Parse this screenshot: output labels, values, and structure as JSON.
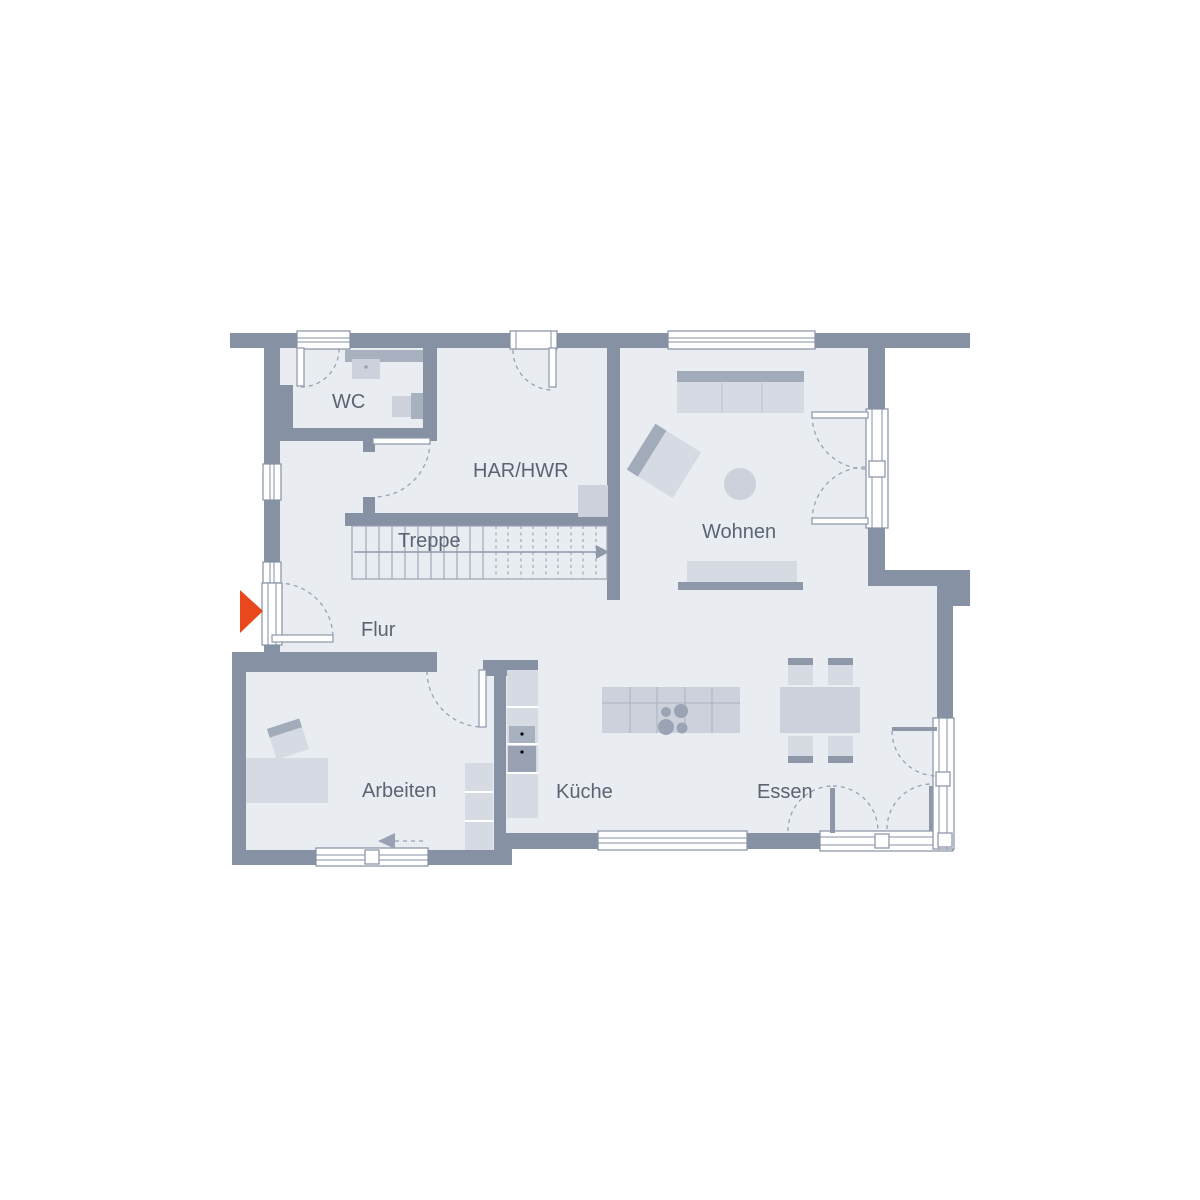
{
  "plan": {
    "type": "ground-floor-plan",
    "background": "#ffffff",
    "rooms": {
      "wc": "WC",
      "har_hwr": "HAR/HWR",
      "treppe": "Treppe",
      "flur": "Flur",
      "wohnen": "Wohnen",
      "arbeiten": "Arbeiten",
      "kueche": "Küche",
      "essen": "Essen"
    },
    "entrance_marker": {
      "shape": "triangle",
      "direction": "right",
      "color": "#e8481c"
    },
    "stairs": {
      "solid_treads": 10,
      "dashed_treads": 9,
      "walkline_direction": "right"
    },
    "colors": {
      "wall": "#8691a3",
      "floor": "#e9ecf1",
      "furniture_light": "#d6dae3",
      "furniture_dark": "#a2abba",
      "outline": "#8e98a9",
      "text": "#5b6472"
    }
  }
}
